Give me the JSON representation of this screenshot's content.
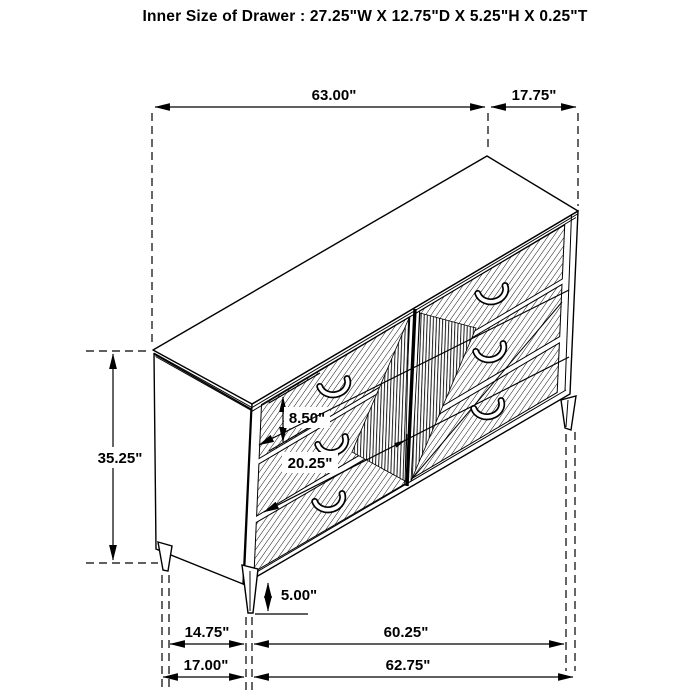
{
  "title": "Inner Size of Drawer : 27.25\"W X 12.75\"D X 5.25\"H X 0.25\"T",
  "dims": {
    "top_width": "63.00\"",
    "top_depth": "17.75\"",
    "overall_height": "35.25\"",
    "drawer_front_height": "8.50\"",
    "drawer_width": "20.25\"",
    "leg_height": "5.00\"",
    "side_depth": "14.75\"",
    "front_width": "60.25\"",
    "base_depth": "17.00\"",
    "base_width": "62.75\""
  }
}
